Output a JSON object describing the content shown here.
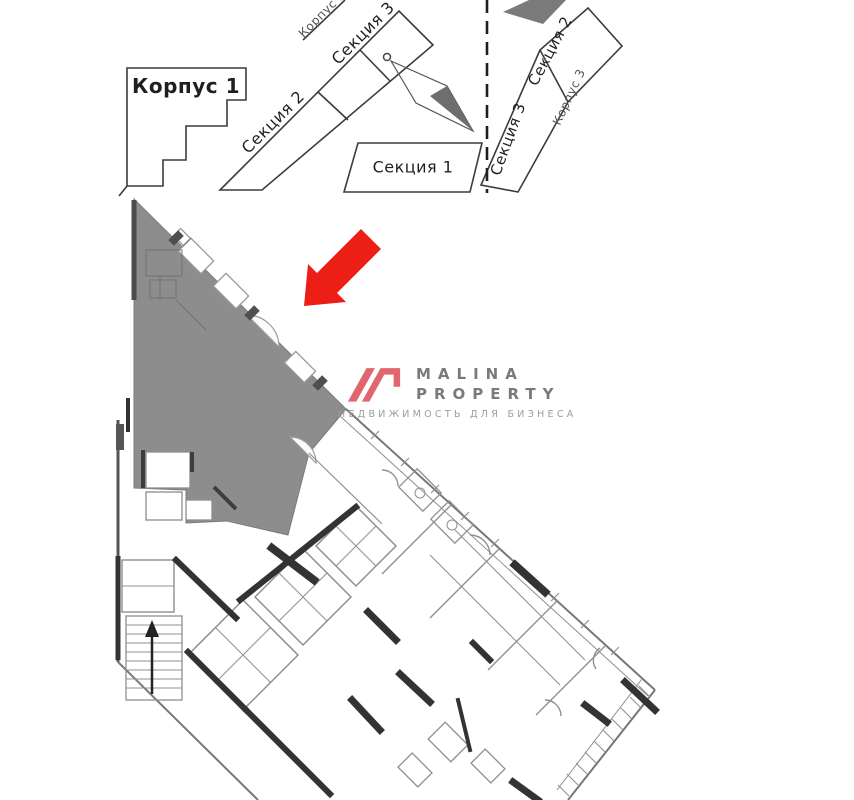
{
  "site_plan": {
    "buildings": {
      "korpus_1": "Корпус 1",
      "korpus_2": "Корпус 2",
      "korpus_3": "Корпус 3"
    },
    "left_wing_sections": {
      "section_2": "Секция 2",
      "section_3": "Секция 3"
    },
    "center_section": {
      "section_1": "Секция 1"
    },
    "right_wing_sections": {
      "section_2": "Секция 2",
      "section_3": "Секция 3"
    }
  },
  "watermark": {
    "brand_top": "MALINA",
    "brand_bottom": "PROPERTY",
    "tagline": "НЕДВИЖИМОСТЬ ДЛЯ БИЗНЕСА"
  },
  "icons": {
    "north_arrow": "north-arrow-icon",
    "unit_pointer": "red-arrow-icon",
    "logo_mark": "malina-logo-icon"
  },
  "colors": {
    "highlighted_unit_fill": "#8d8d8d",
    "site_dark_building_fill": "#7a7a7a",
    "pointer_arrow_red": "#ec1e16",
    "logo_mark_pink": "#e0666d",
    "logo_text_gray": "#7a7a7a",
    "logo_tagline_gray": "#9b9b9b",
    "wall_dark": "#333333",
    "plan_line_gray": "#8f8f8f",
    "dashed_boundary": "#1e1e1e"
  }
}
